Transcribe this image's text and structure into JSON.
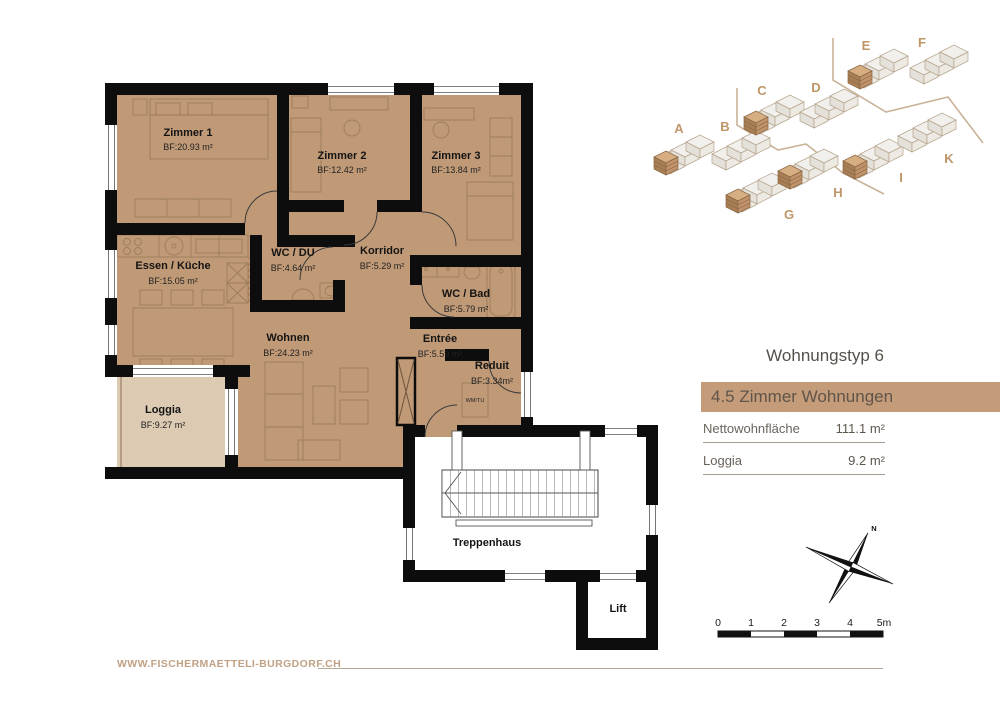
{
  "info_panel": {
    "title": "Wohnungstyp 6",
    "banner": "4.5 Zimmer Wohnungen",
    "rows": [
      {
        "label": "Nettowohnfläche",
        "value": "111.1 m²"
      },
      {
        "label": "Loggia",
        "value": "9.2 m²"
      }
    ]
  },
  "floorplan": {
    "rooms": [
      {
        "name": "Zimmer 1",
        "area": "BF:20.93 m²"
      },
      {
        "name": "Zimmer 2",
        "area": "BF:12.42 m²"
      },
      {
        "name": "Zimmer 3",
        "area": "BF:13.84 m²"
      },
      {
        "name": "Essen / Küche",
        "area": "BF:15.05 m²"
      },
      {
        "name": "WC / DU",
        "area": "BF:4.64 m²"
      },
      {
        "name": "Korridor",
        "area": "BF:5.29 m²"
      },
      {
        "name": "WC / Bad",
        "area": "BF:5.79 m²"
      },
      {
        "name": "Wohnen",
        "area": "BF:24.23 m²"
      },
      {
        "name": "Entrée",
        "area": "BF:5.59 m²"
      },
      {
        "name": "Reduit",
        "area": "BF:3.34m²"
      },
      {
        "name": "Loggia",
        "area": "BF:9.27 m²"
      }
    ],
    "labels": {
      "treppenhaus": "Treppenhaus",
      "lift": "Lift",
      "wm_tu": "WM/TU"
    }
  },
  "siteplan": {
    "buildings": [
      {
        "label": "A",
        "highlighted": true
      },
      {
        "label": "B",
        "highlighted": false
      },
      {
        "label": "C",
        "highlighted": true
      },
      {
        "label": "D",
        "highlighted": false
      },
      {
        "label": "E",
        "highlighted": true
      },
      {
        "label": "F",
        "highlighted": false
      },
      {
        "label": "G",
        "highlighted": true
      },
      {
        "label": "H",
        "highlighted": true
      },
      {
        "label": "I",
        "highlighted": true
      },
      {
        "label": "K",
        "highlighted": false
      }
    ]
  },
  "compass": {
    "north_label": "N"
  },
  "scalebar": {
    "ticks": [
      "0",
      "1",
      "2",
      "3",
      "4",
      "5m"
    ]
  },
  "footer": {
    "website": "WWW.FISCHERMAETTELI-BURGDORF.CH"
  },
  "colors": {
    "floor": "#c09a77",
    "loggia": "#ddcab2",
    "wall": "#0d0d0d",
    "banner": "#c49c79",
    "tan_accent": "#bf9668"
  }
}
